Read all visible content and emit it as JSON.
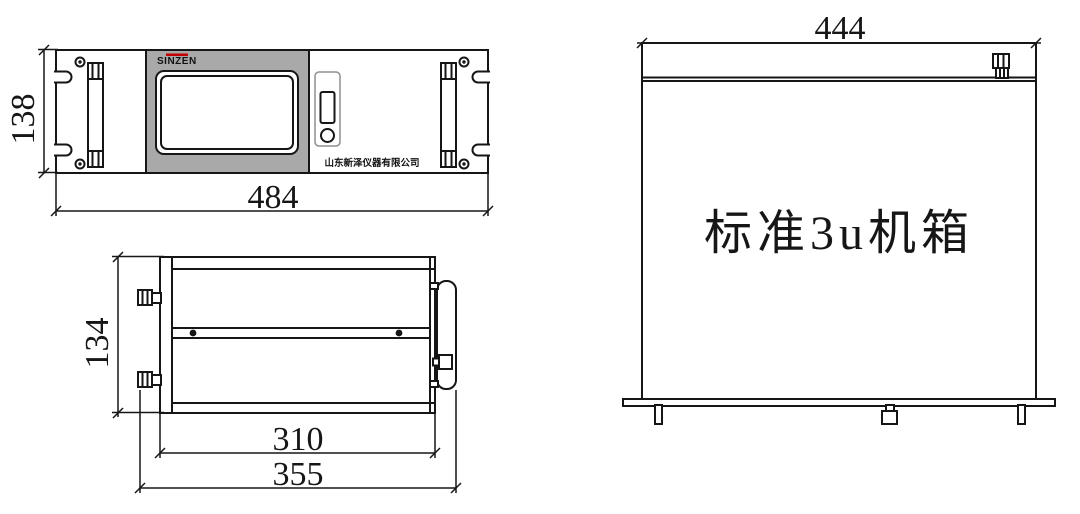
{
  "title": "SINZEN 3U chassis dimension drawing",
  "colors": {
    "line": "#161616",
    "panel_gray": "#a9a9a9",
    "brand_red": "#c40000",
    "connector_gray": "#8f8f8f"
  },
  "front_view": {
    "brand": "SINZEN",
    "company_name": "山东新泽仪器有限公司",
    "height_dim": "138",
    "width_dim": "484"
  },
  "side_view": {
    "height_dim": "134",
    "body_depth_dim": "310",
    "overall_depth_dim": "355"
  },
  "rear_view": {
    "width_dim": "444",
    "label": "标准3u机箱"
  }
}
